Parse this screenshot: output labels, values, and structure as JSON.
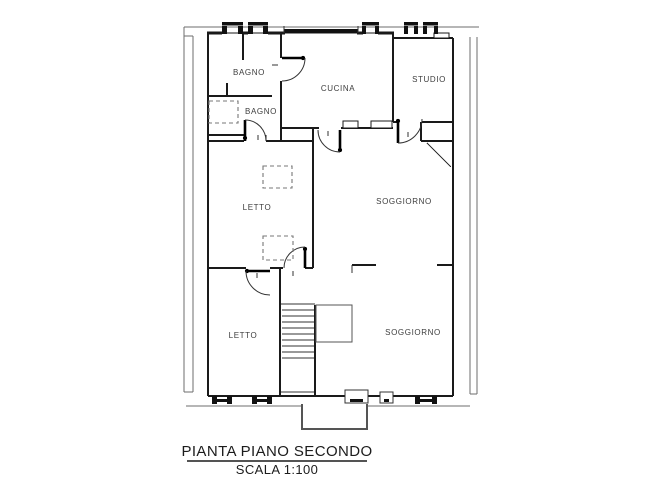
{
  "drawing": {
    "type": "floor-plan",
    "title": "PIANTA PIANO SECONDO",
    "scale_label": "SCALA 1:100"
  },
  "rooms": {
    "bagno_top": "BAGNO",
    "bagno_mid": "BAGNO",
    "cucina": "CUCINA",
    "studio": "STUDIO",
    "letto_mid": "LETTO",
    "soggiorno_mid": "SOGGIORNO",
    "letto_bottom": "LETTO",
    "soggiorno_bottom": "SOGGIORNO"
  },
  "palette": {
    "wall": "#1a1a1a",
    "context_lines": "#6e6e6e",
    "dashed_fixtures": "#777777",
    "text": "#3d3d3d",
    "background": "#ffffff"
  }
}
